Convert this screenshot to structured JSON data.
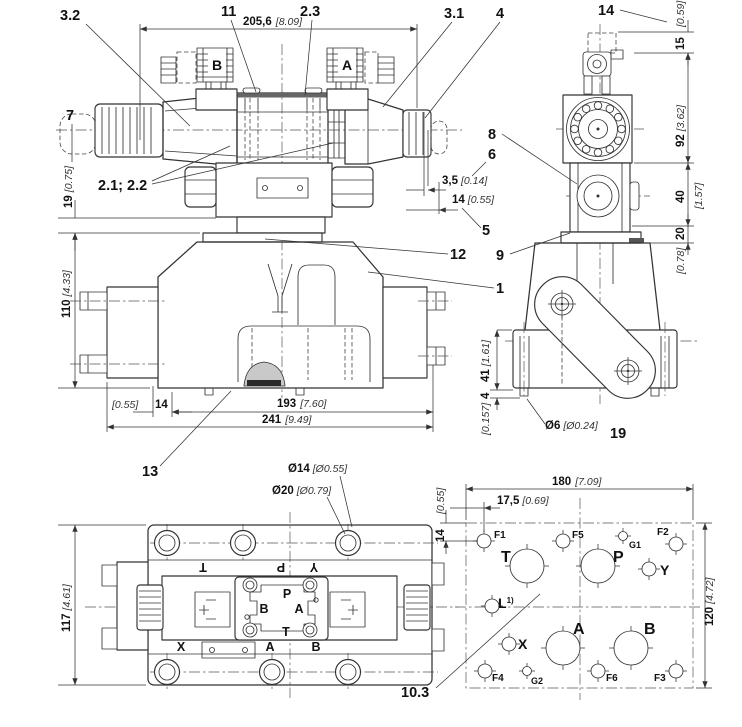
{
  "title": "Directional valve dimensional drawing",
  "colors": {
    "line": "#333333",
    "background": "#ffffff",
    "dim_text": "#111111"
  },
  "front_view": {
    "callouts": {
      "c3_2": "3.2",
      "c11": "11",
      "c2_3": "2.3",
      "c3_1": "3.1",
      "c4": "4",
      "c7": "7",
      "c2_1_2_2": "2.1; 2.2",
      "c12": "12",
      "c1": "1",
      "c13": "13"
    },
    "coils": {
      "left": "B",
      "right": "A"
    },
    "dims": {
      "total_width_mm": "205,6",
      "total_width_in": "[8.09]",
      "h19_mm": "19",
      "h19_in": "[0.75]",
      "h110_mm": "110",
      "h110_in": "[4.33]",
      "off_in": "[0.55]",
      "off_mm": "14",
      "w193_mm": "193",
      "w193_in": "[7.60]",
      "w241_mm": "241",
      "w241_in": "[9.49]",
      "d35_mm": "3,5",
      "d35_in": "[0.14]",
      "d14_mm": "14",
      "d14_in": "[0.55]"
    }
  },
  "side_view": {
    "callouts": {
      "c14": "14",
      "c8": "8",
      "c6": "6",
      "c5": "5",
      "c9": "9",
      "c19": "19"
    },
    "dims": {
      "in059": "[0.59]",
      "h15": "15",
      "h92_mm": "92",
      "h92_in": "[3.62]",
      "h40": "40",
      "h40_in": "[1.57]",
      "h20": "20",
      "h20_in": "[0.78]",
      "h41_mm": "41",
      "h41_in": "[1.61]",
      "h4": "4",
      "h4_in": "[0.157]",
      "pin_mm": "Ø6",
      "pin_in": "[Ø0.24]"
    }
  },
  "bottom_view": {
    "dims": {
      "h117_mm": "117",
      "h117_in": "[4.61]",
      "d14_mm": "Ø14",
      "d14_in": "[Ø0.55]",
      "d20_mm": "Ø20",
      "d20_in": "[Ø0.79]"
    },
    "rotated_labels": {
      "t": "T",
      "p": "P",
      "y": "Y"
    },
    "pilot_labels": {
      "p": "P",
      "b": "B",
      "a": "A",
      "t": "T"
    },
    "bottom_labels": {
      "x": "X",
      "a": "A",
      "b": "B"
    }
  },
  "port_pattern": {
    "callout": "10.3",
    "dims": {
      "w180_mm": "180",
      "w180_in": "[7.09]",
      "o175_mm": "17,5",
      "o175_in": "[0.69]",
      "o14_in": "[0.55]",
      "o14_mm": "14",
      "h120_mm": "120",
      "h120_in": "[4.72]"
    },
    "ports": {
      "f1": "F1",
      "f5": "F5",
      "g1": "G1",
      "f2": "F2",
      "t": "T",
      "p": "P",
      "y": "Y",
      "l": "L",
      "l_sup": "1)",
      "x": "X",
      "a": "A",
      "b": "B",
      "f4": "F4",
      "g2": "G2",
      "f6": "F6",
      "f3": "F3"
    }
  }
}
